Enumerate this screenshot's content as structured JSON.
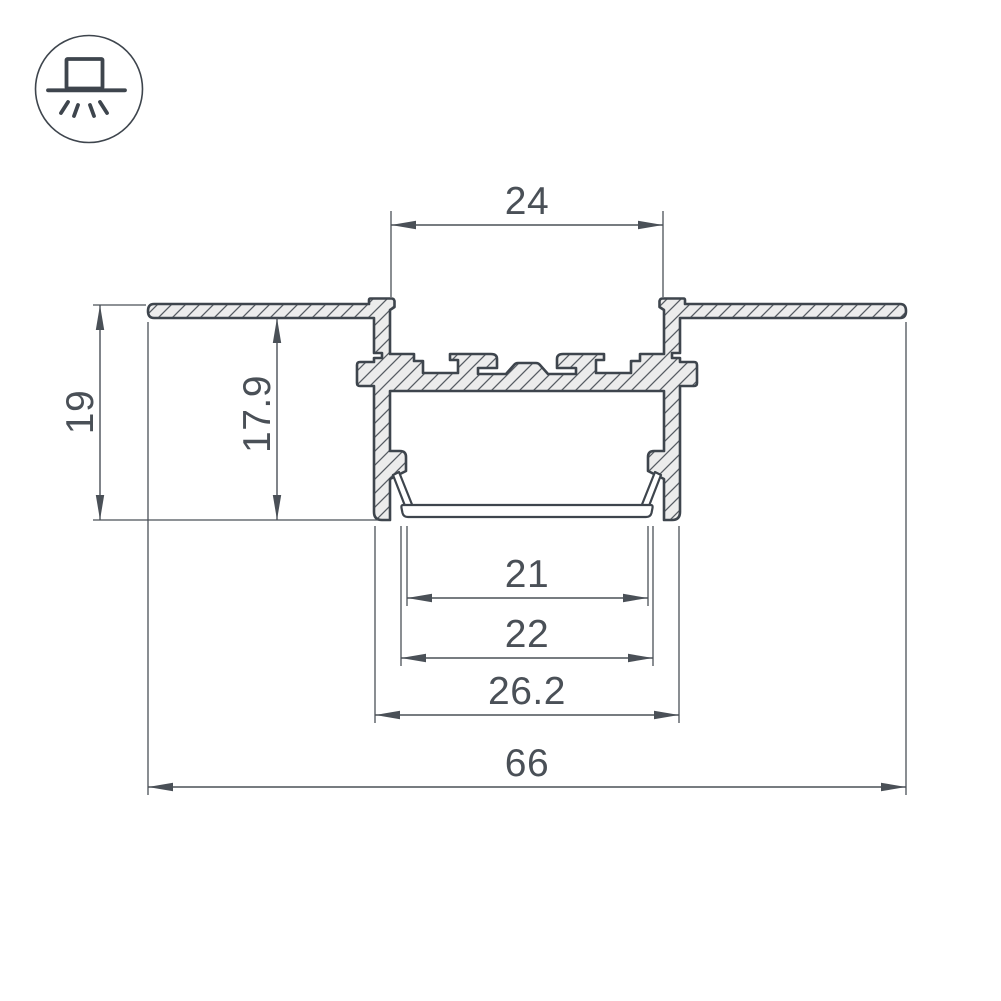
{
  "page": {
    "background": "#ffffff"
  },
  "badge": {
    "icon": "recessed-ceiling-mount-icon"
  },
  "drawing": {
    "type": "technical-cross-section",
    "dimensions": {
      "top_opening_width": "24",
      "overall_height": "19",
      "inner_height": "17.9",
      "bottom_opening_width": "21",
      "diffuser_width": "22",
      "body_width": "26.2",
      "flange_width": "66"
    },
    "colors": {
      "outline": "#3e454d",
      "dimension": "#4a5057",
      "fill": "#ececec",
      "hatch": "#565c63",
      "background": "#ffffff"
    }
  }
}
